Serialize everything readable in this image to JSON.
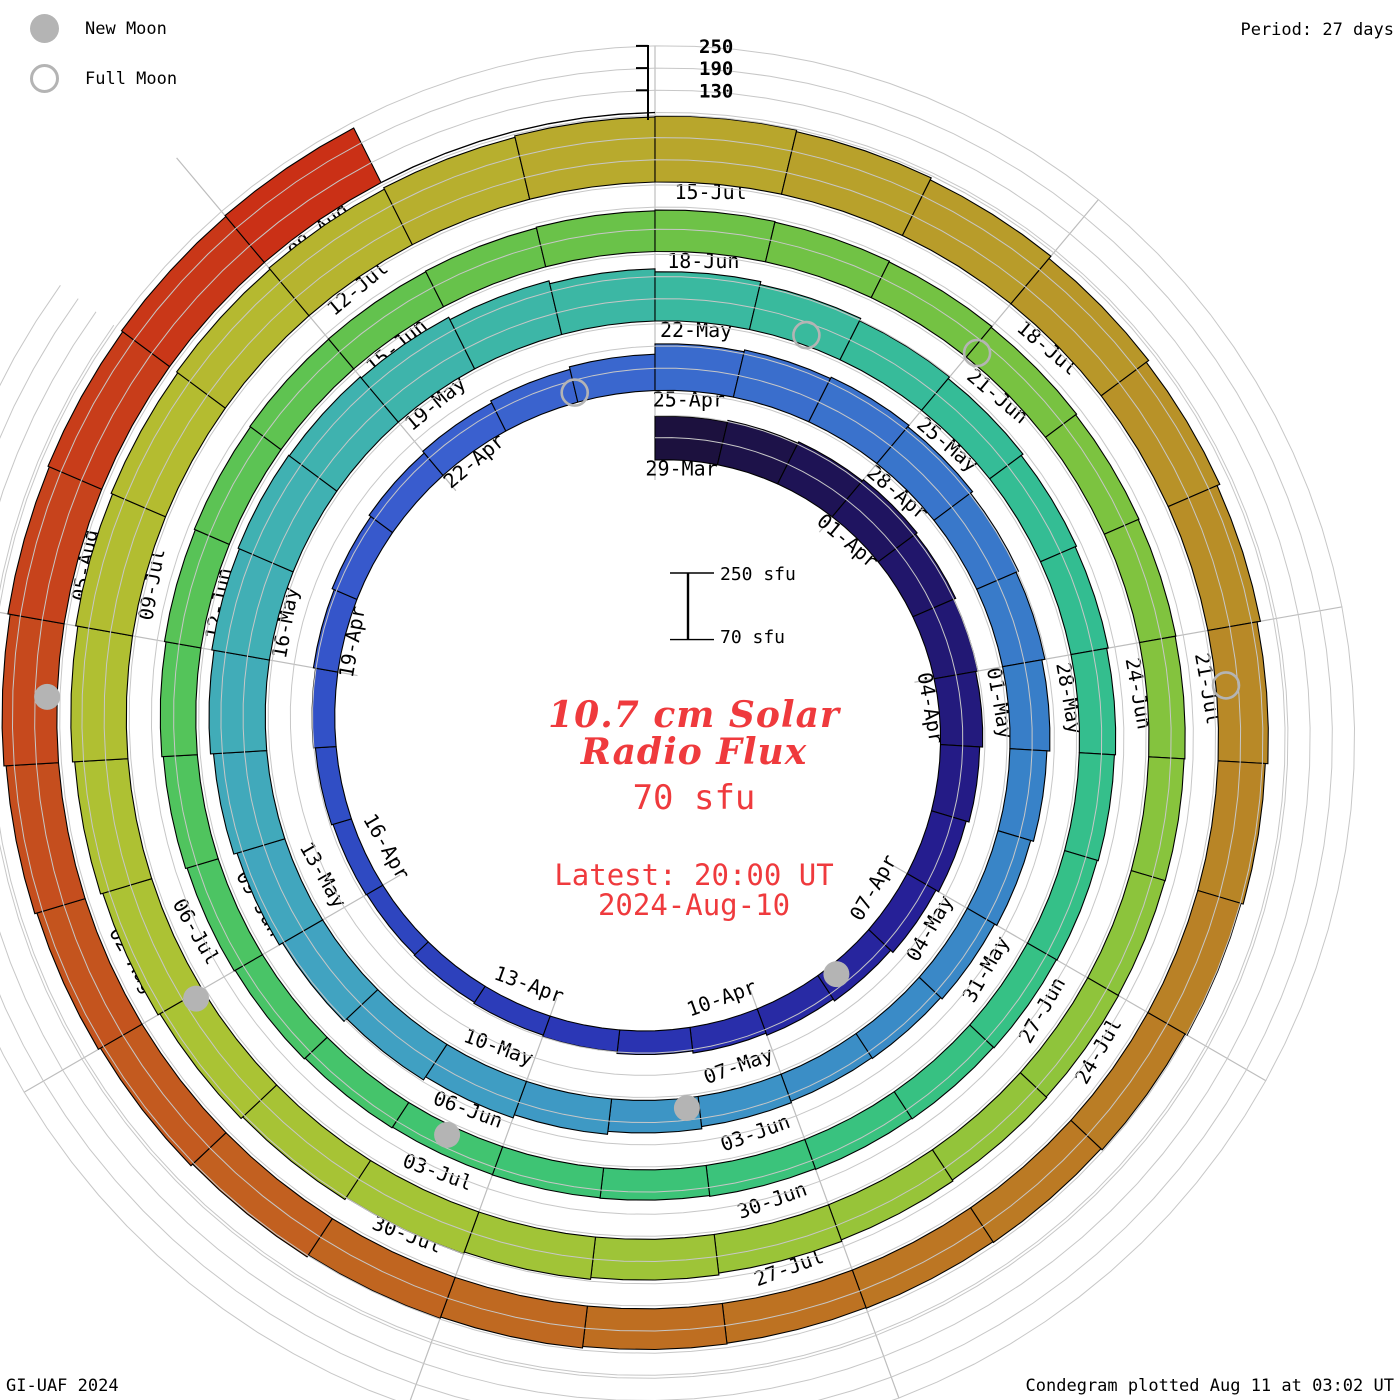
{
  "header": {
    "period_label": "Period: 27 days"
  },
  "legend": {
    "new_moon": "New Moon",
    "full_moon": "Full Moon"
  },
  "footer": {
    "left": "GI-UAF 2024",
    "right": "Condegram plotted Aug 11 at 03:02 UT"
  },
  "center": {
    "title_line1": "10.7 cm Solar",
    "title_line2": "Radio Flux",
    "value": "70 sfu",
    "latest_line1": "Latest: 20:00 UT",
    "latest_line2": "2024-Aug-10",
    "scale_top": "250 sfu",
    "scale_bottom": "70 sfu"
  },
  "radial_axis": {
    "ticks": [
      250,
      190,
      130
    ]
  },
  "chart_data": {
    "type": "bar",
    "subtype": "condegram-spiral",
    "title": "10.7 cm Solar Radio Flux",
    "units": "sfu",
    "period_days": 27,
    "start_date": "2024-03-29",
    "end_date_plotted": "2024-08-08",
    "latest_report": "2024-Aug-10 20:00 UT",
    "baseline_sfu": 70,
    "gridline_levels_sfu": [
      130,
      190,
      250
    ],
    "axis_tick_levels_sfu": [
      250,
      190,
      130
    ],
    "segment_labels": [
      "29-Mar",
      "01-Apr",
      "04-Apr",
      "07-Apr",
      "10-Apr",
      "13-Apr",
      "16-Apr",
      "19-Apr",
      "22-Apr",
      "25-Apr",
      "28-Apr",
      "01-May",
      "04-May",
      "07-May",
      "10-May",
      "13-May",
      "16-May",
      "19-May",
      "22-May",
      "25-May",
      "28-May",
      "31-May",
      "03-Jun",
      "06-Jun",
      "09-Jun",
      "12-Jun",
      "15-Jun",
      "18-Jun",
      "21-Jun",
      "24-Jun",
      "27-Jun",
      "30-Jun",
      "03-Jul",
      "06-Jul",
      "09-Jul",
      "12-Jul",
      "15-Jul",
      "18-Jul",
      "21-Jul",
      "24-Jul",
      "27-Jul",
      "30-Jul",
      "02-Aug",
      "05-Aug",
      "08-Aug"
    ],
    "daily_flux_sfu": [
      188,
      193,
      197,
      201,
      196,
      190,
      184,
      176,
      168,
      160,
      152,
      146,
      140,
      134,
      129,
      125,
      122,
      120,
      122,
      126,
      131,
      137,
      143,
      149,
      155,
      161,
      168,
      196,
      201,
      205,
      200,
      193,
      186,
      178,
      170,
      162,
      155,
      150,
      148,
      152,
      158,
      166,
      175,
      185,
      195,
      205,
      214,
      222,
      228,
      232,
      230,
      226,
      219,
      211,
      203,
      195,
      188,
      182,
      176,
      172,
      168,
      165,
      162,
      160,
      158,
      156,
      154,
      152,
      151,
      150,
      152,
      155,
      158,
      162,
      166,
      170,
      173,
      175,
      176,
      178,
      180,
      182,
      180,
      178,
      175,
      172,
      170,
      168,
      166,
      165,
      166,
      168,
      171,
      175,
      180,
      185,
      190,
      196,
      202,
      208,
      214,
      220,
      226,
      230,
      234,
      238,
      242,
      246,
      248,
      244,
      238,
      230,
      222,
      214,
      205,
      198,
      192,
      186,
      182,
      180,
      178,
      180,
      184,
      188,
      194,
      200,
      206,
      212,
      218,
      224,
      228,
      232,
      235
    ],
    "moons": [
      {
        "type": "new",
        "date": "2024-04-08",
        "t": 10.77
      },
      {
        "type": "new",
        "date": "2024-05-08",
        "t": 40.14
      },
      {
        "type": "new",
        "date": "2024-06-06",
        "t": 69.53
      },
      {
        "type": "new",
        "date": "2024-07-05",
        "t": 98.96
      },
      {
        "type": "new",
        "date": "2024-08-04",
        "t": 128.47
      },
      {
        "type": "full",
        "date": "2024-04-23",
        "t": 25.99
      },
      {
        "type": "full",
        "date": "2024-05-23",
        "t": 55.58
      },
      {
        "type": "full",
        "date": "2024-06-21",
        "t": 84.05
      },
      {
        "type": "full",
        "date": "2024-07-21",
        "t": 114.43
      }
    ],
    "colors": {
      "moon_marker": "#b4b4b4",
      "grid_gray": "#c7c7c7",
      "radial_gray": "#bdbdbd",
      "annotation_red": "#ef3a3d",
      "bar_outline": "#000000",
      "colormap_stops": [
        [
          0,
          "#1b1038"
        ],
        [
          4,
          "#201566"
        ],
        [
          9,
          "#261e94"
        ],
        [
          14,
          "#2a35b4"
        ],
        [
          19,
          "#2f4cc4"
        ],
        [
          24,
          "#3a5ecf"
        ],
        [
          29,
          "#3a70cc"
        ],
        [
          34,
          "#3880c8"
        ],
        [
          39,
          "#3b90c6"
        ],
        [
          44,
          "#41a2c2"
        ],
        [
          49,
          "#41b0b4"
        ],
        [
          54,
          "#3bb8a2"
        ],
        [
          59,
          "#33bd92"
        ],
        [
          64,
          "#36c184"
        ],
        [
          69,
          "#3fc472"
        ],
        [
          74,
          "#52c45c"
        ],
        [
          79,
          "#65c24c"
        ],
        [
          84,
          "#76c242"
        ],
        [
          89,
          "#8ac43c"
        ],
        [
          94,
          "#9cc438"
        ],
        [
          99,
          "#abc334"
        ],
        [
          104,
          "#b5bb30"
        ],
        [
          108,
          "#b8a82c"
        ],
        [
          112,
          "#b89428"
        ],
        [
          116,
          "#b88326"
        ],
        [
          120,
          "#bc7422"
        ],
        [
          124,
          "#c16320"
        ],
        [
          127,
          "#c4511e"
        ],
        [
          130,
          "#c7401b"
        ],
        [
          133,
          "#cb2d15"
        ]
      ]
    },
    "layout_hints": {
      "direction": "clockwise, period start at 12 o'clock",
      "legend_position": "top-left",
      "grid": true
    }
  }
}
